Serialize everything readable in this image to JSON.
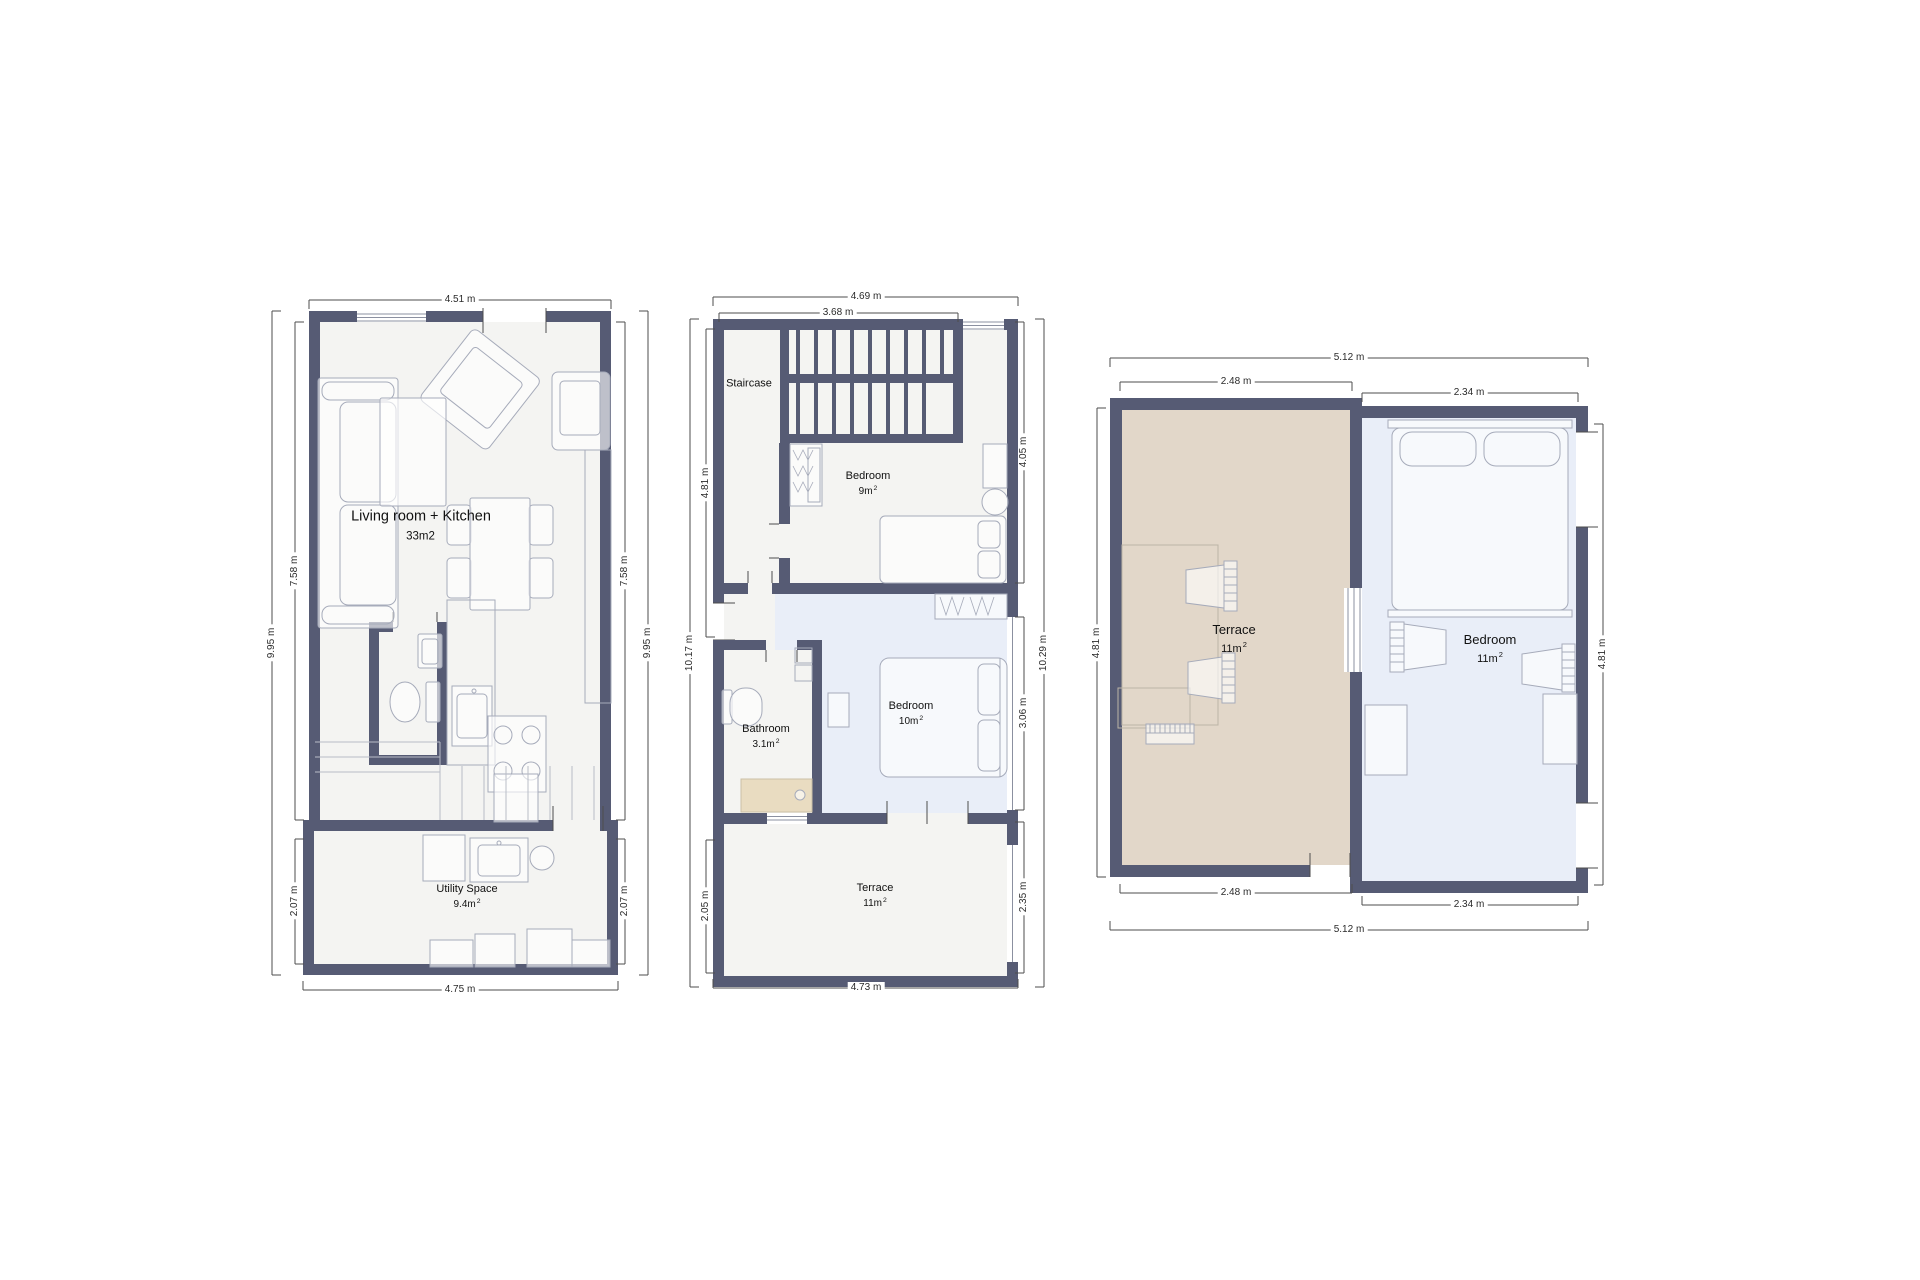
{
  "colors": {
    "wall": "#565b74",
    "floor": "#f4f4f2",
    "terrace_floor": "#e2d7c9",
    "bedroom_floor": "#e9eef8",
    "shower_tray": "#e9dcc1",
    "furniture_stroke": "#a6abba",
    "dimension_line": "#4d4d4d"
  },
  "plans": [
    {
      "name": "floor-1",
      "rooms": [
        {
          "name": "Living room + Kitchen",
          "area": "33m2",
          "sup": ""
        },
        {
          "name": "Utility Space",
          "area": "9.4m",
          "sup": "2"
        }
      ],
      "dims": {
        "top": "4.51 m",
        "bottom": "4.75 m",
        "left_outer": "9.95 m",
        "left_upper": "7.58 m",
        "left_lower": "2.07 m",
        "right_outer": "9.95 m",
        "right_upper": "7.58 m",
        "right_lower": "2.07 m"
      }
    },
    {
      "name": "floor-2",
      "rooms": [
        {
          "name": "Staircase",
          "area": "",
          "sup": ""
        },
        {
          "name": "Bedroom",
          "area": "9m",
          "sup": "2"
        },
        {
          "name": "Bathroom",
          "area": "3.1m",
          "sup": "2"
        },
        {
          "name": "Bedroom",
          "area": "10m",
          "sup": "2"
        },
        {
          "name": "Terrace",
          "area": "11m",
          "sup": "2"
        }
      ],
      "dims": {
        "top_outer": "4.69 m",
        "top_inner": "3.68 m",
        "bottom": "4.73 m",
        "left_outer": "10.17 m",
        "left_upper": "4.81 m",
        "left_lower": "2.05 m",
        "right_outer": "10.29 m",
        "right_upper": "4.05 m",
        "right_middle": "3.06 m",
        "right_lower": "2.35 m"
      }
    },
    {
      "name": "floor-3",
      "rooms": [
        {
          "name": "Terrace",
          "area": "11m",
          "sup": "2"
        },
        {
          "name": "Bedroom",
          "area": "11m",
          "sup": "2"
        }
      ],
      "dims": {
        "top_outer": "5.12 m",
        "top_left": "2.48 m",
        "top_right": "2.34 m",
        "left": "4.81 m",
        "right": "4.81 m",
        "bottom_left": "2.48 m",
        "bottom_right": "2.34 m",
        "bottom_outer": "5.12 m"
      }
    }
  ]
}
